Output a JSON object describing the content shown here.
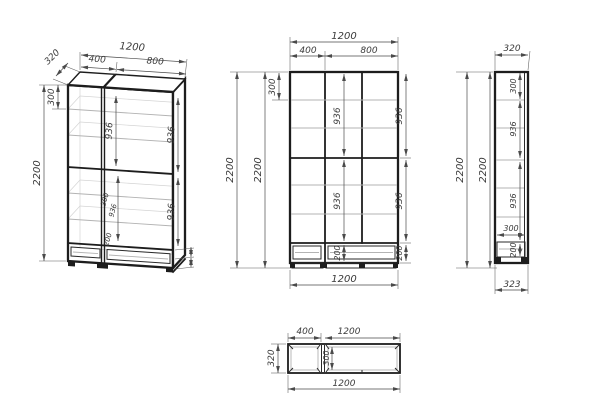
{
  "drawing": {
    "type": "furniture technical drawing (wardrobe, 3 orthographic views + isometric)",
    "colors": {
      "ink": "#1d1d1d",
      "dimension": "#4a4a4a",
      "shelf": "#b3b3b3",
      "background": "#ffffff"
    }
  },
  "views": {
    "iso": {
      "depth": "320",
      "left_width": "400",
      "total_width": "1200",
      "right_width": "800",
      "top_section": "300",
      "height": "2200",
      "mid_upper": "936",
      "right_upper": "936",
      "mid_lower_a": "300",
      "mid_lower_b": "936",
      "mid_drawer": "200",
      "right_lower": "936"
    },
    "front": {
      "total_width": "1200",
      "left_width": "400",
      "right_width": "800",
      "height_a": "2200",
      "height_b": "2200",
      "top_section": "300",
      "mid_upper": "936",
      "right_upper": "936",
      "mid_lower": "936",
      "right_lower": "936",
      "mid_drawer": "200",
      "right_drawer": "200",
      "bottom_width": "1200"
    },
    "side": {
      "top_width": "320",
      "height_a": "2200",
      "height_b": "2200",
      "top_section": "300",
      "upper": "936",
      "lower": "936",
      "drawer_depth": "300",
      "drawer_height": "200",
      "bottom_width": "323"
    },
    "top": {
      "left_width": "400",
      "right_width": "1200",
      "depth": "320",
      "inner_depth": "300",
      "bottom_width": "1200"
    }
  }
}
